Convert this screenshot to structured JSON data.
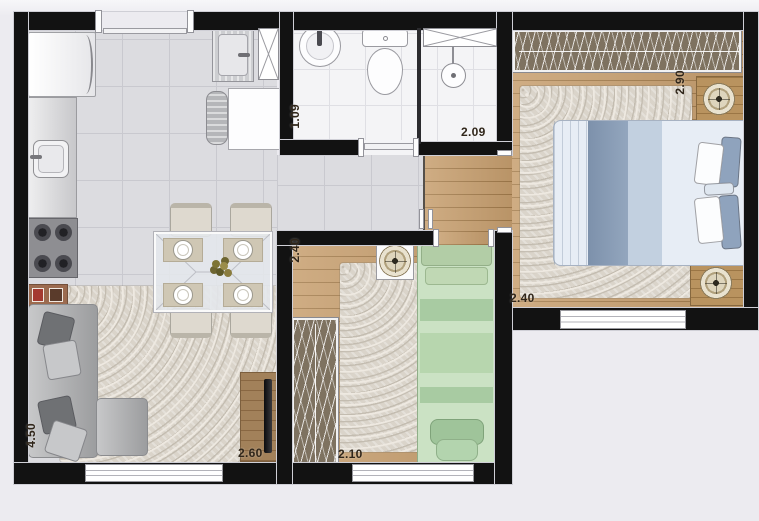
{
  "plan": {
    "background_color": "#ecebf0",
    "wall_color": "#121212",
    "label_color": "#30261a",
    "rooms": {
      "bathroom": {
        "width_m": "1.09",
        "depth_m": "2.09"
      },
      "master_bedroom": {
        "width_m": "2.90",
        "depth_m": "2.40"
      },
      "second_bedroom": {
        "width_m": "2.40",
        "depth_m": "2.10"
      },
      "living_kitchen": {
        "depth_m": "4.50",
        "width_m": "2.60"
      }
    },
    "floors": {
      "tile_color": "#dcdce0",
      "wood_color": "#c79f6f",
      "bath_tile_color": "#f4f4f6",
      "rug_color": "#dad4ca"
    },
    "furniture_icons": [
      "refrigerator-icon",
      "kitchen-counter-icon",
      "kitchen-sink-icon",
      "stove-icon",
      "side-table-icon",
      "laundry-tank-icon",
      "washing-machine-icon",
      "duct-shaft-icon",
      "bathroom-sink-icon",
      "toilet-icon",
      "shower-icon",
      "sofa-icon",
      "dining-table-icon",
      "dining-chair-icon",
      "flower-centerpiece-icon",
      "tv-console-icon",
      "tv-icon",
      "wardrobe-icon",
      "double-bed-icon",
      "single-bed-icon",
      "nightstand-icon",
      "lamp-icon",
      "pouf-icon",
      "rug-icon",
      "window-icon",
      "door-icon"
    ]
  }
}
